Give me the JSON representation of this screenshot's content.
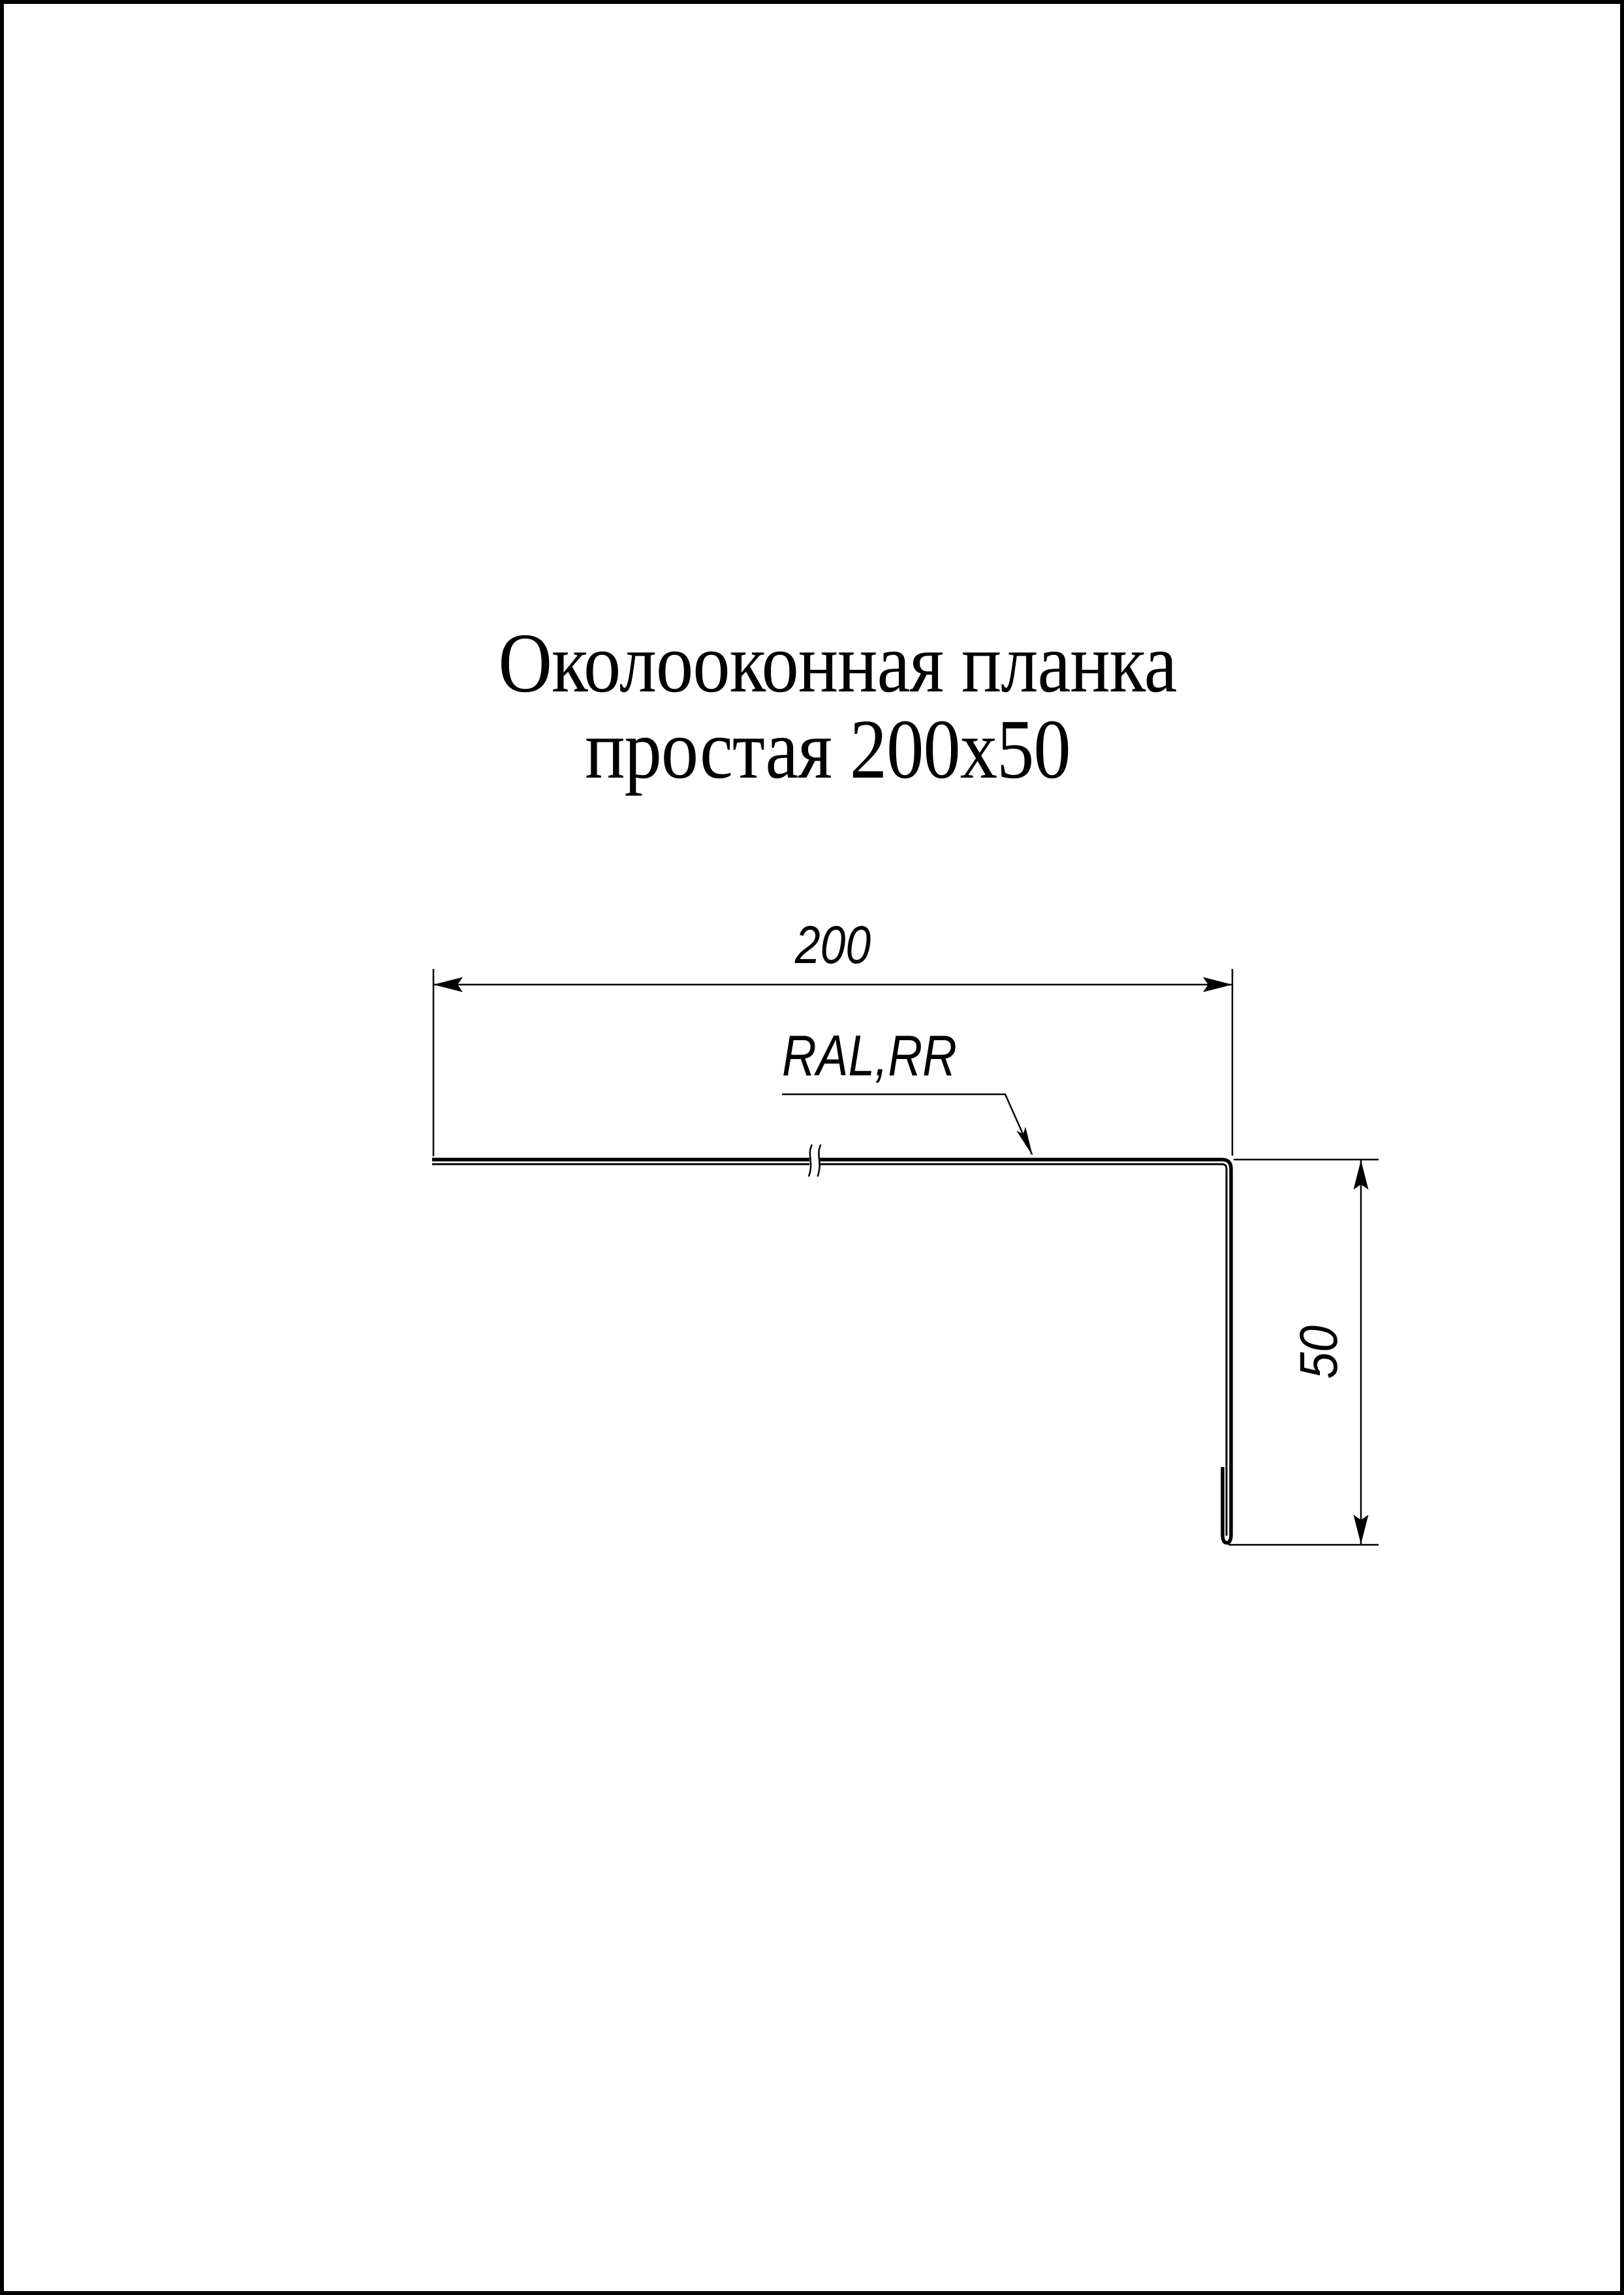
{
  "page": {
    "background_color": "#ffffff",
    "line_color": "#000000",
    "border_color": "#000000"
  },
  "title": {
    "line1": "Околооконная планка",
    "line2": "простая 200x50"
  },
  "drawing": {
    "type": "sheet-metal-profile-cross-section",
    "part_name": "Околооконная планка простая 200x50",
    "width_dimension": "200",
    "height_dimension": "50",
    "coating_label": "RAL,RR"
  }
}
